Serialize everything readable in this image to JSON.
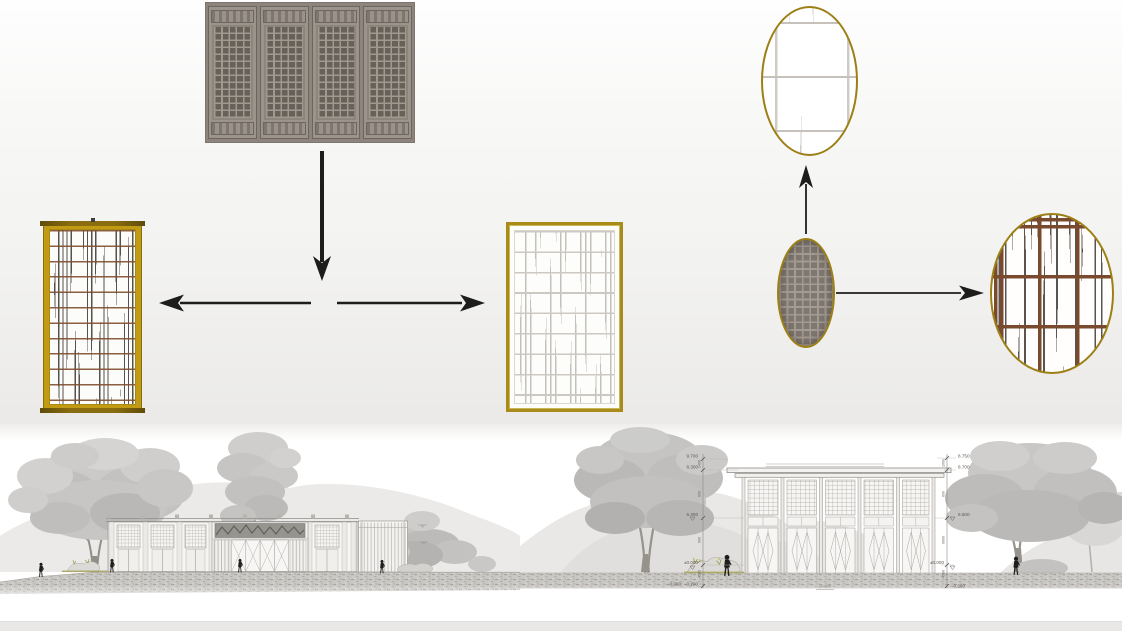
{
  "colors": {
    "background_top": "#fefefe",
    "background_low": "#ebeae8",
    "drawing_area": "#ffffff",
    "footer_strip": "#e9e8e6",
    "arrow": "#1d1d1b",
    "gold_frame": "#c19b14",
    "gold_frame_dark": "#8a6d10",
    "ellipse_outline": "#9c7f15",
    "photo_wood_base": "#9c948b",
    "photo_wood_dark": "#68615a",
    "panel_brown_line": "#804e2e",
    "panel_dark_stroke": "#3e3933",
    "panel_light_line": "#cdc9c2",
    "detail_brown_grid": "#7a4a2f",
    "line_art_gray": "#8f8d89",
    "foliage_light": "#cecdcb",
    "foliage_dark": "#b2b1af",
    "ground_gray": "#c9c7c3",
    "silhouette_black": "#1e1e1c",
    "plant_olive": "#9aa052"
  },
  "annotations": {
    "left_chain": {
      "levels": [
        "9.700",
        "8.300",
        "6.300",
        "±0.000",
        "-0.200"
      ],
      "dims": [
        "1400",
        "600",
        "900",
        "4500"
      ]
    },
    "right_chain": {
      "levels": [
        "8.750",
        "8.700",
        "6.500",
        "±0.000",
        "-0.200"
      ],
      "dims": [
        "1000",
        "600",
        "9000",
        "4500"
      ]
    },
    "floor_mark": "±0.000"
  }
}
